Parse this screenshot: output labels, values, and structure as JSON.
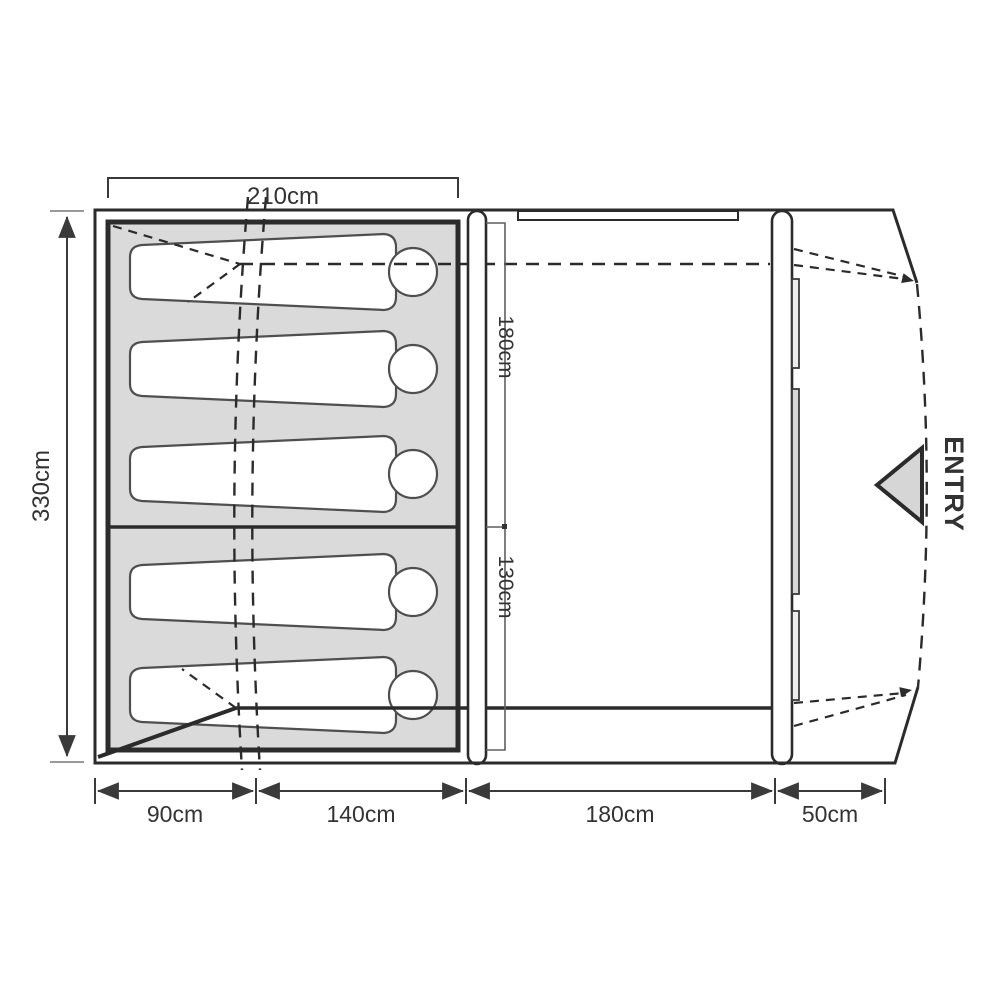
{
  "diagram": {
    "type": "tent-floorplan",
    "sleeper_count": 5,
    "labels": {
      "top_width": "210cm",
      "left_height": "330cm",
      "inner_upper": "180cm",
      "inner_lower": "130cm",
      "entry": "ENTRY"
    },
    "bottom_segments": [
      {
        "label": "90cm"
      },
      {
        "label": "140cm"
      },
      {
        "label": "180cm"
      },
      {
        "label": "50cm"
      }
    ],
    "colors": {
      "line": "#2b2b2b",
      "bedroom_fill": "#dadada",
      "entry_fill": "#d6d6d6",
      "label_text": "#333333"
    }
  }
}
